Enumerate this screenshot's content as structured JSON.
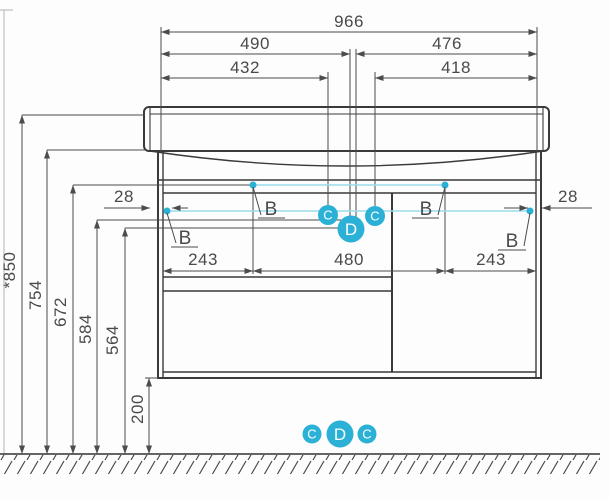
{
  "colors": {
    "accent": "#2ab1d5",
    "accent_light": "#9adced",
    "line": "#3a3a3a",
    "dim_line": "#4c4c4c",
    "text": "#4a4a4a",
    "background": "#fdfdfd"
  },
  "dims": {
    "d966": "966",
    "d490": "490",
    "d476": "476",
    "d432": "432",
    "d418": "418",
    "d243_left": "243",
    "d480": "480",
    "d243_right": "243",
    "d28_left": "28",
    "d28_right": "28",
    "d850": "*850",
    "d754": "754",
    "d672": "672",
    "d584": "584",
    "d564": "564",
    "d200": "200"
  },
  "markers": {
    "b": "B",
    "c": "C",
    "d": "D"
  }
}
